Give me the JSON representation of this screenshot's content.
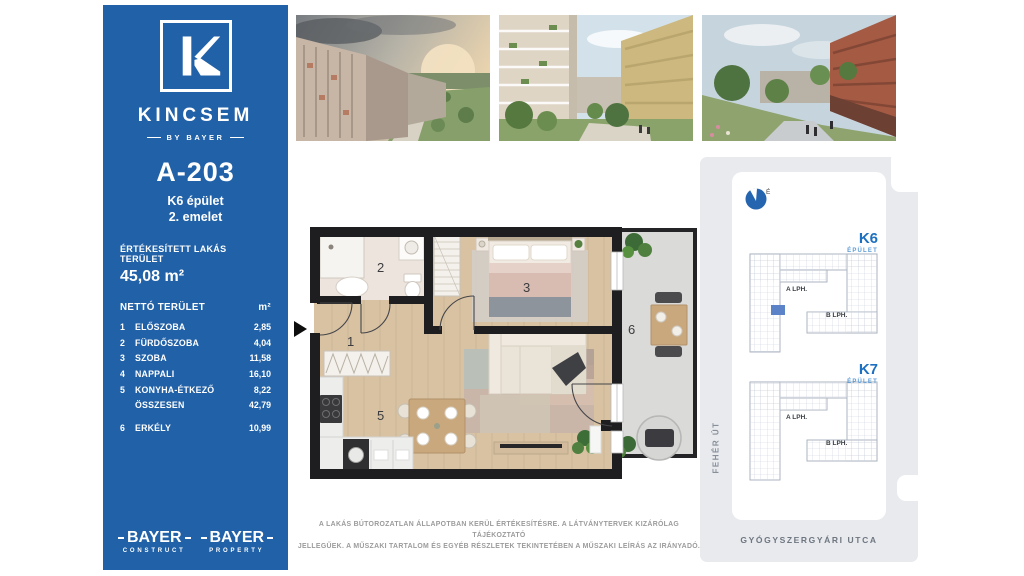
{
  "sidebar": {
    "background": "#2161A8",
    "brand": {
      "logo_letter": "K",
      "name": "KINCSEM",
      "byline": "BY BAYER"
    },
    "unit": {
      "code": "A-203",
      "building": "K6 épület",
      "floor": "2. emelet"
    },
    "area": {
      "label": "ÉRTÉKESÍTETT LAKÁS TERÜLET",
      "value": "45,08 m²"
    },
    "table": {
      "header": {
        "label": "NETTÓ TERÜLET",
        "unit": "m²"
      },
      "rows": [
        {
          "no": "1",
          "name": "ELŐSZOBA",
          "value": "2,85"
        },
        {
          "no": "2",
          "name": "FÜRDŐSZOBA",
          "value": "4,04"
        },
        {
          "no": "3",
          "name": "SZOBA",
          "value": "11,58"
        },
        {
          "no": "4",
          "name": "NAPPALI",
          "value": "16,10"
        },
        {
          "no": "5",
          "name": "KONYHA-ÉTKEZŐ",
          "value": "8,22"
        },
        {
          "no": "",
          "name": "ÖSSZESEN",
          "value": "42,79"
        },
        {
          "no": "6",
          "name": "ERKÉLY",
          "value": "10,99"
        }
      ]
    },
    "logos": [
      {
        "name": "BAYER",
        "division": "CONSTRUCT"
      },
      {
        "name": "BAYER",
        "division": "PROPERTY"
      }
    ]
  },
  "floorplan": {
    "labels": {
      "eloszoba": "1",
      "furdoszoba": "2",
      "szoba": "3",
      "konyha": "5",
      "erkely": "6"
    },
    "colors": {
      "wall": "#1e1e20",
      "wood": "#d8c2a2",
      "tile": "#ece4dd",
      "concrete": "#dadad8"
    }
  },
  "disclaimer": {
    "line1": "A LAKÁS BÚTOROZATLAN ÁLLAPOTBAN KERÜL ÉRTÉKESÍTÉSRE. A LÁTVÁNYTERVEK KIZÁRÓLAG TÁJÉKOZTATÓ",
    "line2": "JELLEGŰEK. A MŰSZAKI TARTALOM ÉS EGYÉB RÉSZLETEK TEKINTETÉBEN A MŰSZAKI LEÍRÁS AZ IRÁNYADÓ."
  },
  "map": {
    "north": "É",
    "k6": {
      "title": "K6",
      "subtitle": "ÉPÜLET",
      "stair_a": "A LPH.",
      "stair_b": "B LPH."
    },
    "k7": {
      "title": "K7",
      "subtitle": "ÉPÜLET",
      "stair_a": "A LPH.",
      "stair_b": "B LPH."
    },
    "streets": {
      "west": "FEHÉR ÚT",
      "south": "GYÓGYSZERGYÁRI UTCA"
    },
    "highlight": "#5c82c8",
    "accent": "#1d6fc0"
  }
}
